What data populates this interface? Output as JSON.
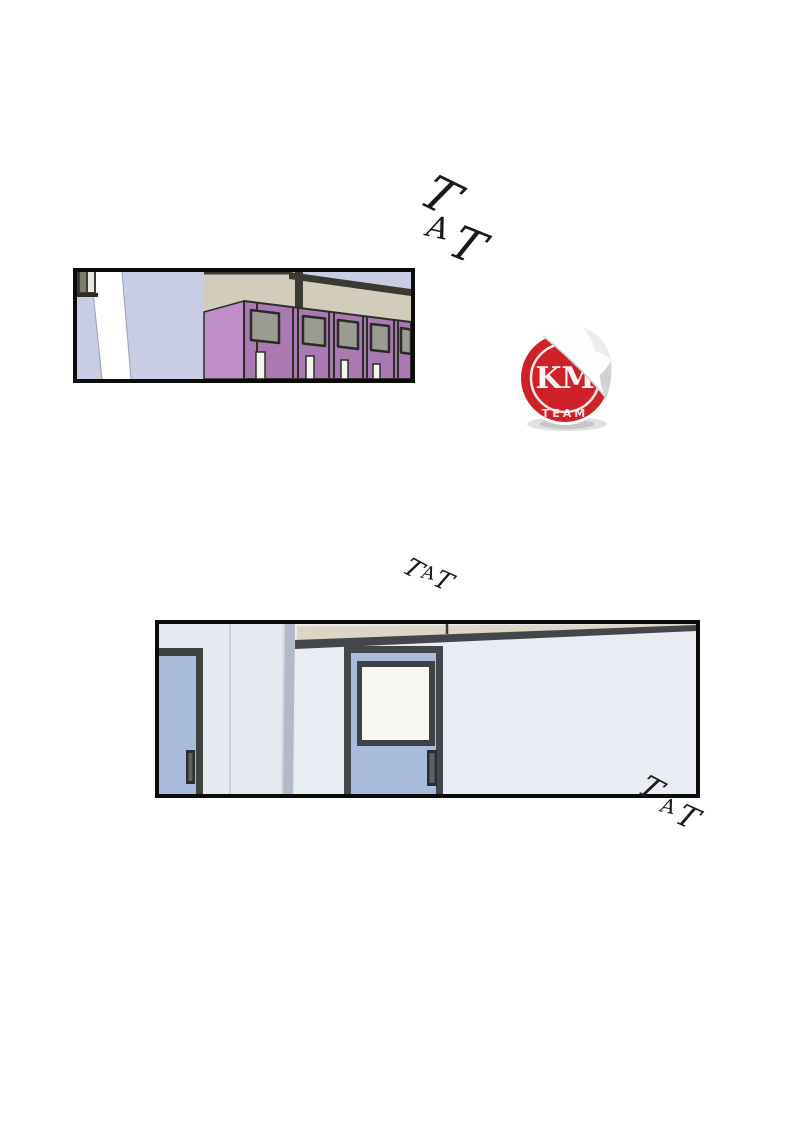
{
  "page": {
    "width": 800,
    "height": 1135,
    "background": "#ffffff"
  },
  "panel_1": {
    "name": "locker-hallway-panel",
    "description": "school hallway corner with a row of purple lockers",
    "colors": {
      "wall_lavender": "#c9cde3",
      "wall_beige": "#d2ccbd",
      "locker_front": "#a87ab1",
      "locker_side": "#c18fc8",
      "locker_window": "#9b9b93",
      "trim_dark": "#3a3a32"
    }
  },
  "panel_2": {
    "name": "door-hallway-panel",
    "description": "hallway wall with two blue classroom doors",
    "colors": {
      "wall": "#e7e9f0",
      "door_blue": "#a9bcd9",
      "frame_dark": "#43464a",
      "door_window": "#f8f8f3",
      "transom_beige": "#ddd6c6",
      "column": "#b2b9c8"
    }
  },
  "sfx": {
    "top": {
      "text": "TAT",
      "letters": [
        "T",
        "A",
        "T"
      ]
    },
    "middle": {
      "text": "TAT",
      "letters": [
        "T",
        "A",
        "T"
      ]
    },
    "bottom": {
      "text": "TAT",
      "letters": [
        "T",
        "A",
        "T"
      ]
    }
  },
  "sticker": {
    "monogram": "KM",
    "team_label": "TEAM",
    "colors": {
      "red": "#cf2228",
      "white": "#ffffff"
    }
  },
  "ink": "#1a1a1a"
}
